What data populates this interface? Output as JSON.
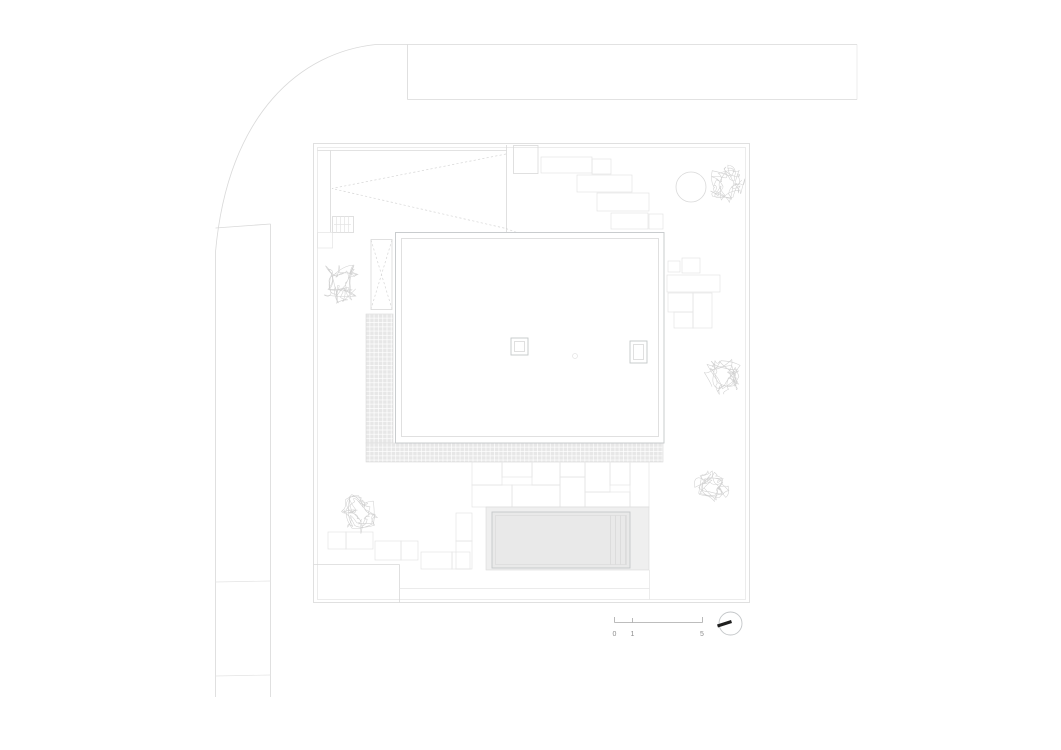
{
  "drawing": {
    "plan_type": "architectural site / roof plan",
    "scale_bar": {
      "labels": [
        "0",
        "1",
        "5"
      ]
    },
    "north_indicator": {
      "symbol": "circle-with-black-bar"
    },
    "trees": [
      {
        "cx": 340,
        "cy": 281,
        "r": 22
      },
      {
        "cx": 727,
        "cy": 183,
        "r": 19
      },
      {
        "cx": 723,
        "cy": 375,
        "r": 20
      },
      {
        "cx": 712,
        "cy": 487,
        "r": 17
      },
      {
        "cx": 362,
        "cy": 513,
        "r": 21
      }
    ],
    "colors": {
      "background": "#ffffff",
      "line_faint": "#e4e4e4",
      "line_light": "#d9d9d9",
      "line_medium": "#c4c7c9",
      "line_dark": "#a8a8a8",
      "dash": "#d6d6d6",
      "tile_fill": "#e7e7e7",
      "fill_deck": "#efefef",
      "fill_pool": "#e9e9e9",
      "tree": "#cfcfcf",
      "text": "#8c8c8c",
      "north_bar": "#1f1f1f"
    }
  }
}
